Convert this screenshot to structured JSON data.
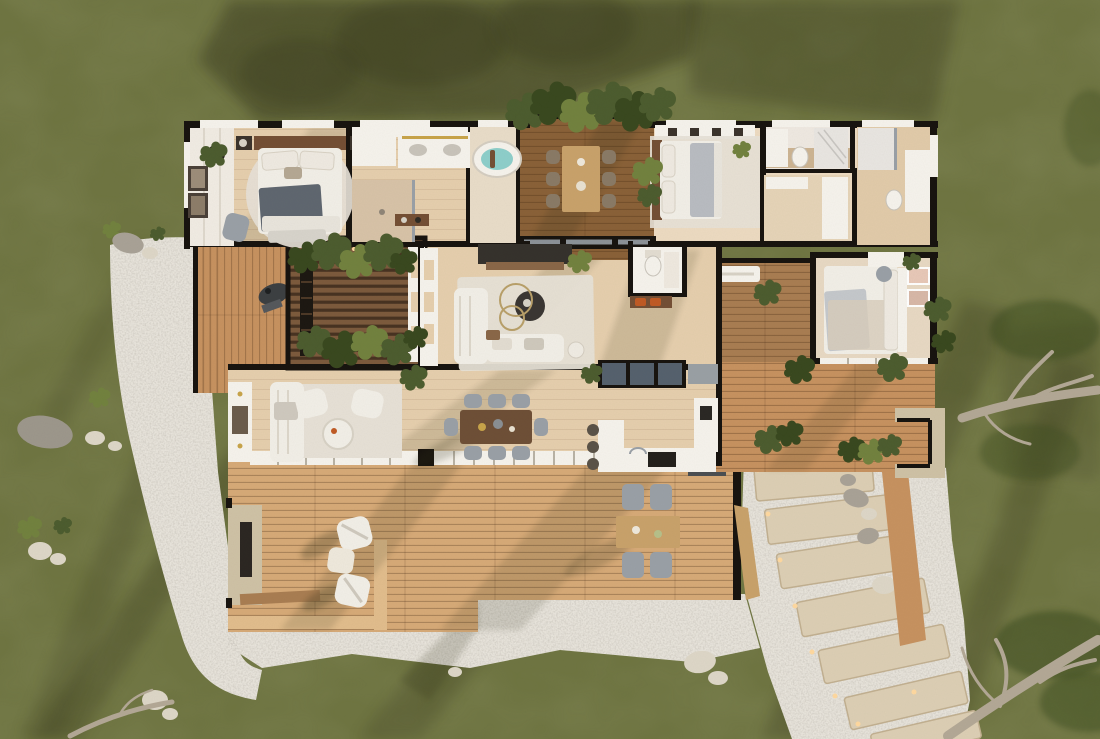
{
  "scene": {
    "type": "architectural-floor-plan-render",
    "view": "top-down-aerial-3d-cutaway",
    "setting": "single-storey house on a green lawn with white gravel borders, timber decks and a winding stone-slab path"
  },
  "palette": {
    "grass": "#6f7542",
    "grass_dark": "#545e31",
    "gravel": "#e9e5dd",
    "slab": "#ddcfb5",
    "slab_edge": "#c2b091",
    "deck": "#c79260",
    "deck_light": "#d7aa78",
    "deck_dark": "#a97d52",
    "deck_rim": "#e2bd8d",
    "court": "#7c5a3d",
    "floor": "#e6cfae",
    "floor_light": "#eddbc2",
    "wall": "#17130f",
    "white": "#f6f3ed",
    "rug": "#e7e1d7",
    "sofa": "#f2efe8",
    "gray": "#9aa0a7",
    "gray_dark": "#5c6066",
    "wood": "#744f35",
    "wood_light": "#c9a26b",
    "dark": "#33302b",
    "glass": "#55616e",
    "water": "#8ecfcb",
    "orange": "#c05a24",
    "gold": "#c8a44a",
    "plant": "#4c5c2f",
    "plant_dark": "#39481f",
    "plant_light": "#72823f",
    "stone": "#cfc2a6",
    "trunk": "#b3a896",
    "rock": "#a9a297",
    "rock_white": "#ded7c8",
    "light": "#ffd9a0",
    "shadow": "#2e2d18",
    "marble": "#e9e6e2"
  },
  "rooms": [
    {
      "name": "bedroom-left",
      "furniture": [
        "double-bed",
        "round-rug",
        "nightstands",
        "lounge-chair",
        "wall-art",
        "wardrobe"
      ]
    },
    {
      "name": "bathroom-main",
      "furniture": [
        "double-vanity",
        "walk-in-shower",
        "spa-tub",
        "hall-console"
      ]
    },
    {
      "name": "covered-dining-deck",
      "furniture": [
        "dining-table-for-six",
        "planter-greenery"
      ]
    },
    {
      "name": "bedroom-master",
      "furniture": [
        "double-bed",
        "wardrobe",
        "area-rug",
        "potted-plant"
      ]
    },
    {
      "name": "bathroom-ensuite",
      "furniture": [
        "toilet",
        "vanity",
        "marble-shower"
      ]
    },
    {
      "name": "hall-closets",
      "furniture": [
        "built-in-wardrobes"
      ]
    },
    {
      "name": "bathroom-rear",
      "furniture": [
        "shower",
        "vanity",
        "toilet"
      ]
    },
    {
      "name": "bedroom-right",
      "furniture": [
        "double-bed",
        "desk-with-chair",
        "wall-art",
        "picture-windows"
      ]
    },
    {
      "name": "powder-room",
      "furniture": [
        "toilet",
        "vanity",
        "bench-with-orange-cushions"
      ]
    },
    {
      "name": "living-room-center",
      "furniture": [
        "l-shaped-sofa",
        "round-coffee-table",
        "media-wall",
        "area-rug",
        "shelf-wall"
      ]
    },
    {
      "name": "living-room-front",
      "furniture": [
        "sofa",
        "two-armchairs",
        "round-coffee-table",
        "fireplace-console"
      ]
    },
    {
      "name": "dining-room",
      "furniture": [
        "eight-seat-dark-timber-table"
      ]
    },
    {
      "name": "kitchen",
      "furniture": [
        "island-with-stools",
        "l-shaped-counter",
        "cooktop",
        "skylight-glazing"
      ]
    }
  ],
  "outdoor": [
    {
      "name": "pergola-courtyard",
      "features": [
        "slatted-roof",
        "planter-rows",
        "ladder",
        "downlights",
        "shelf-pillar"
      ]
    },
    {
      "name": "west-deck",
      "features": [
        "bbq-grill",
        "white-planter-boxes"
      ]
    },
    {
      "name": "main-deck",
      "features": [
        "outdoor-stone-fireplace",
        "two-lounge-chairs",
        "side-table",
        "outdoor-dining-set",
        "timber-gate",
        "step-platform"
      ]
    },
    {
      "name": "east-deck",
      "features": [
        "built-in-bench",
        "potted-plants",
        "stone-seating-nook",
        "planter-wall"
      ]
    },
    {
      "name": "stone-step-path",
      "features": [
        "rotated-stone-slabs",
        "white-gravel",
        "path-lights",
        "boulders"
      ]
    },
    {
      "name": "lawn",
      "features": [
        "long-tree-shadows",
        "scattered-rocks",
        "fallen-branches",
        "gravel-border",
        "dead-trees-right-edge"
      ]
    }
  ]
}
